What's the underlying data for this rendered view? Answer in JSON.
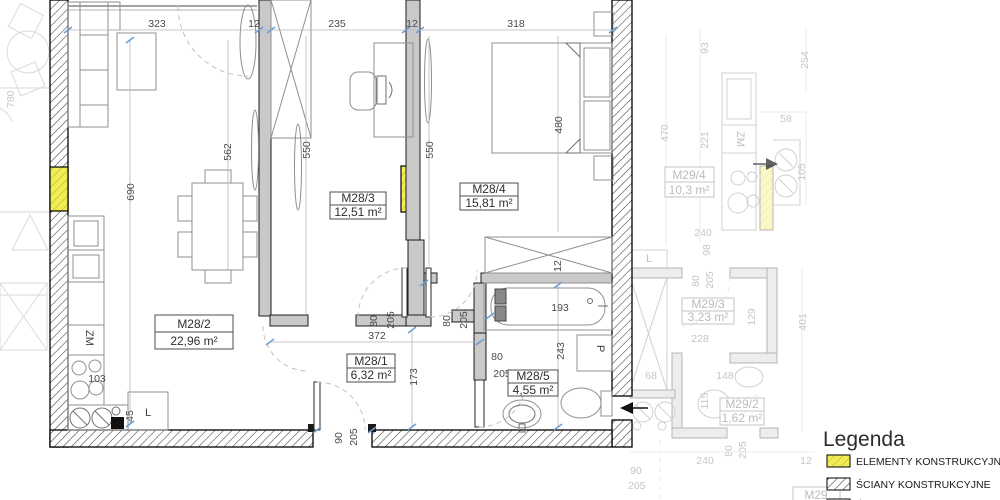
{
  "plan": {
    "rooms": [
      {
        "id": "M28/1",
        "area": "6,32 m²"
      },
      {
        "id": "M28/2",
        "area": "22,96 m²"
      },
      {
        "id": "M28/3",
        "area": "12,51 m²"
      },
      {
        "id": "M28/4",
        "area": "15,81 m²"
      },
      {
        "id": "M28/5",
        "area": "4,55 m²"
      }
    ],
    "adjacent_rooms": [
      {
        "id": "M29/4",
        "area": "10,3 m²"
      },
      {
        "id": "M29/3",
        "area": "3,23 m²"
      },
      {
        "id": "M29/2",
        "area": "1,62 m²"
      },
      {
        "id": "M29",
        "area": ""
      }
    ],
    "appliances": {
      "dishwasher": "ZM",
      "fridge": "L",
      "washing_machine": "P"
    }
  },
  "dims": {
    "d323": "323",
    "d12": "12",
    "d235": "235",
    "d318": "318",
    "d690": "690",
    "d562": "562",
    "d550": "550",
    "d480": "480",
    "d780": "780",
    "d103": "103",
    "d45": "45",
    "d372": "372",
    "d173": "173",
    "d80": "80",
    "d205": "205",
    "d90": "90",
    "d193": "193",
    "d243": "243",
    "d470": "470",
    "d93": "93",
    "d254": "254",
    "d221": "221",
    "d58": "58",
    "d105": "105",
    "d240": "240",
    "d98": "98",
    "d129": "129",
    "d228": "228",
    "d401": "401",
    "d148": "148",
    "d115": "115",
    "d68": "68"
  },
  "legend": {
    "title": "Legenda",
    "items": [
      "ELEMENTY KONSTRUKCYJNE",
      "ŚCIANY KONSTRUKCYJNE",
      "ŚCIANY DZIAŁOWE (możliwość"
    ]
  },
  "colors": {
    "structural_element": "#f1ee55",
    "wall_fill": "#c9c9c9",
    "dim_tick": "#6b9fd4"
  }
}
